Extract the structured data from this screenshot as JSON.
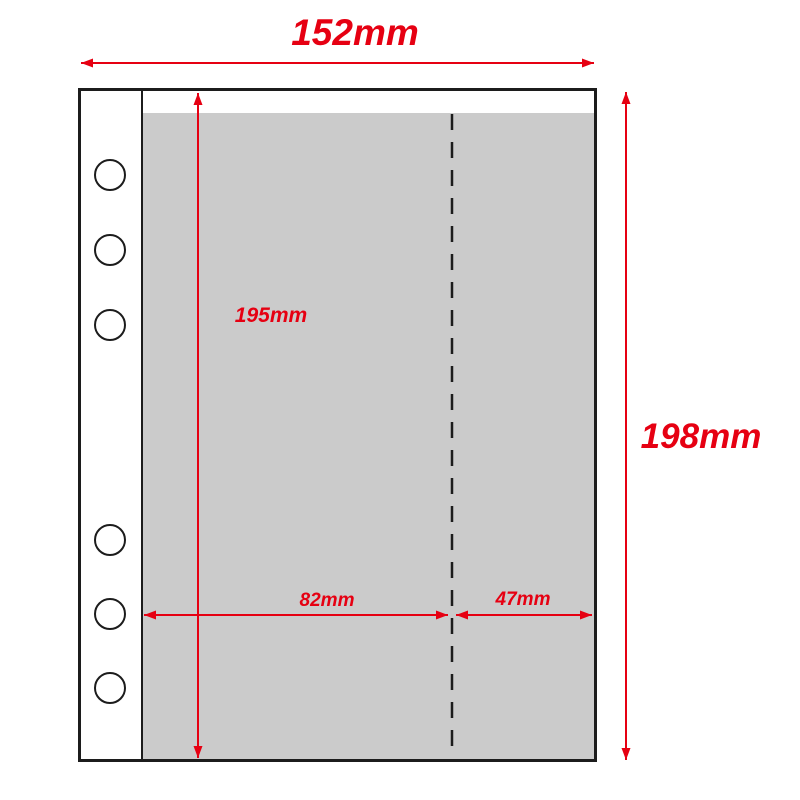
{
  "dimensions": {
    "width": {
      "label": "152mm"
    },
    "height": {
      "label": "198mm"
    },
    "pocket_height": {
      "label": "195mm"
    },
    "left_section_width": {
      "label": "82mm"
    },
    "right_section_width": {
      "label": "47mm"
    }
  },
  "holes": {
    "count": 6,
    "groups": 2,
    "per_group": 3
  },
  "colors": {
    "background": "#ffffff",
    "outline_black": "#1c1c1c",
    "pocket_gray": "#cbcbcb",
    "dimension_red": "#e60012"
  }
}
